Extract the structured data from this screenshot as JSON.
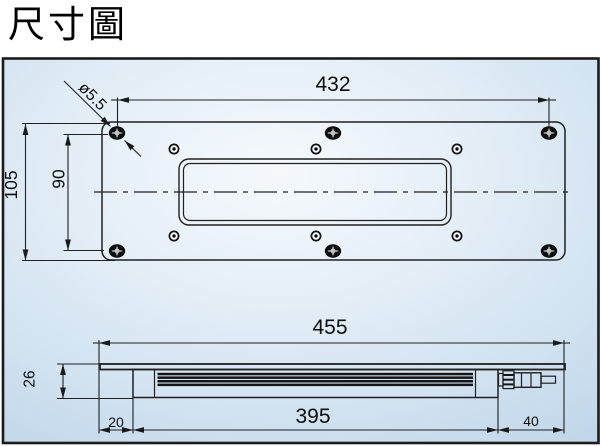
{
  "title": "尺寸圖",
  "dims": {
    "hole_dia": "ø5.5",
    "top_width": "432",
    "plate_height": "105",
    "hole_span_height": "90",
    "overall_length": "455",
    "profile_height": "26",
    "end_offset": "20",
    "body_length": "395",
    "connector_len": "40"
  }
}
